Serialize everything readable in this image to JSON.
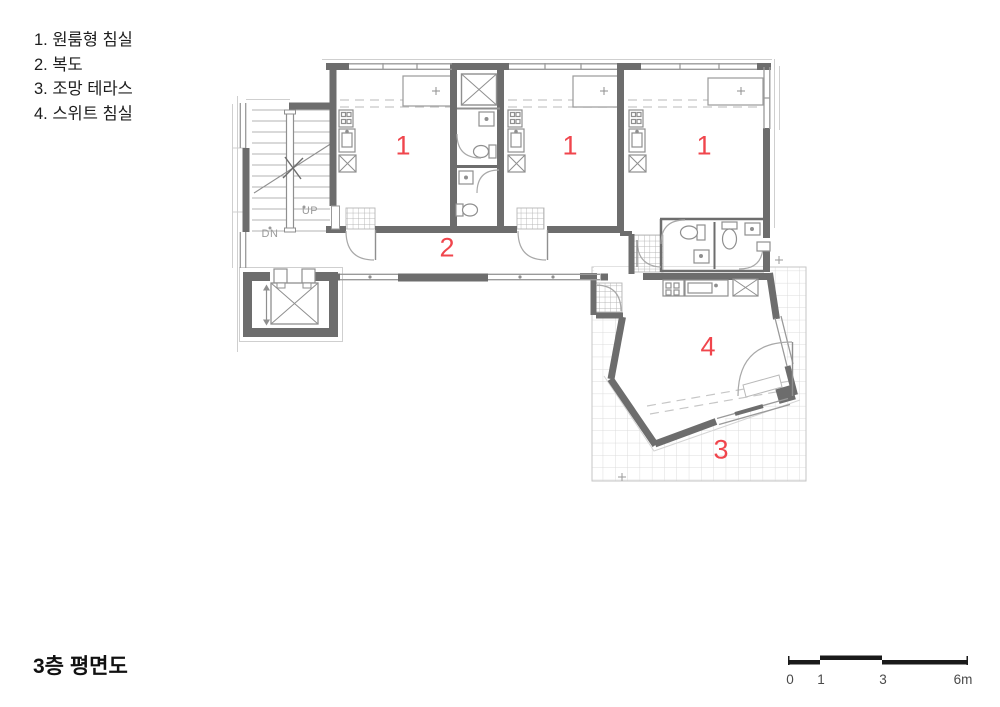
{
  "legend": {
    "items": [
      "1. 원룸형 침실",
      "2. 복도",
      "3. 조망 테라스",
      "4. 스위트 침실"
    ]
  },
  "title": "3층 평면도",
  "scale_bar": {
    "labels": [
      "0",
      "1",
      "3",
      "6m"
    ]
  },
  "plan": {
    "room_numbers": [
      "1",
      "1",
      "1",
      "2",
      "4",
      "3"
    ],
    "stair_labels": {
      "up": "UP",
      "down": "DN"
    }
  },
  "colors": {
    "wall": "#6d6d6d",
    "line_medium": "#8f8f8f",
    "line_light": "#c9c9c9",
    "terrace_grid": "#dcdcdc",
    "room_number_red": "#f0454c",
    "text": "#1d1d1d",
    "scale_text": "#4a4a4a",
    "scale_bar": "#1a1a1a"
  }
}
